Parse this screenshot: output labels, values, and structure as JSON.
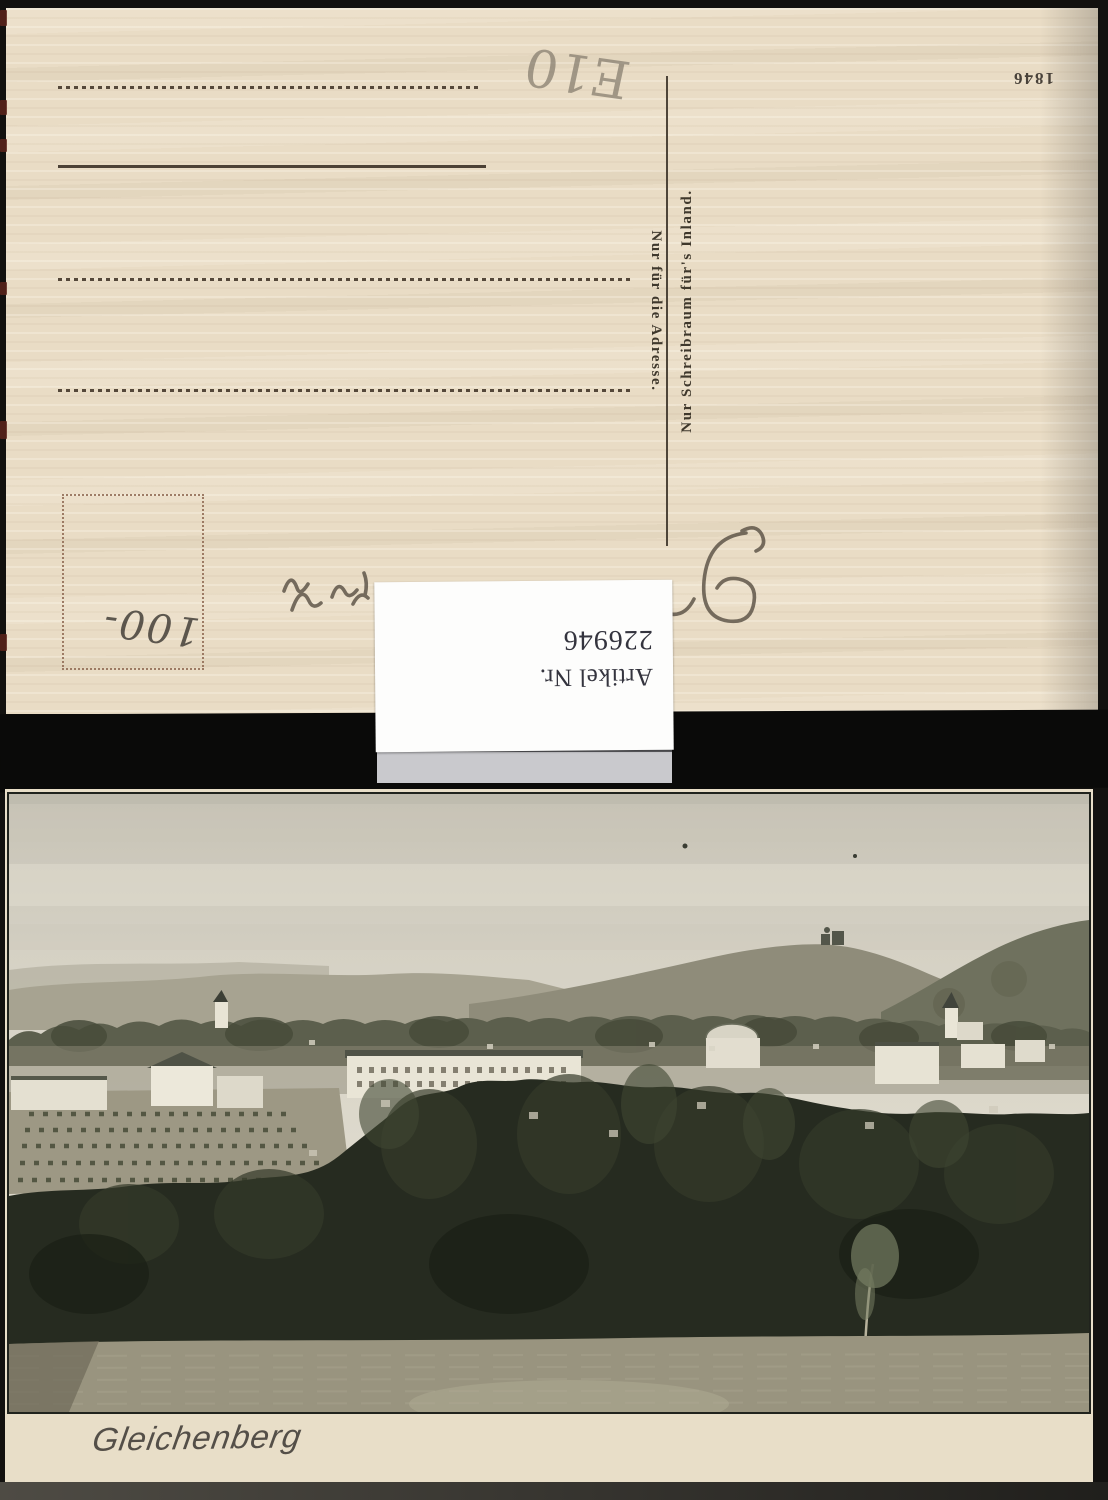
{
  "postcard_back": {
    "inventory_number": "1846",
    "divider_text_left": "Nur für die Adresse.",
    "divider_text_right": "Nur Schreibraum für's Inland.",
    "handwriting": {
      "price": "100-",
      "note": "E10"
    }
  },
  "article_label": {
    "line1": "Artikel Nr.",
    "line2": "226946"
  },
  "postcard_front": {
    "caption": "Gleichenberg"
  },
  "colors": {
    "paper_cream": "#e9dcc5",
    "separator_black": "#0a0a09",
    "label_background": "#fdfdfc",
    "label_text": "#34343e",
    "print_ink": "#3f382c",
    "caption_ink": "#544f48",
    "photo_sky": "#d8d4c7",
    "photo_trees": "#262b20",
    "photo_meadow": "#99947f"
  }
}
